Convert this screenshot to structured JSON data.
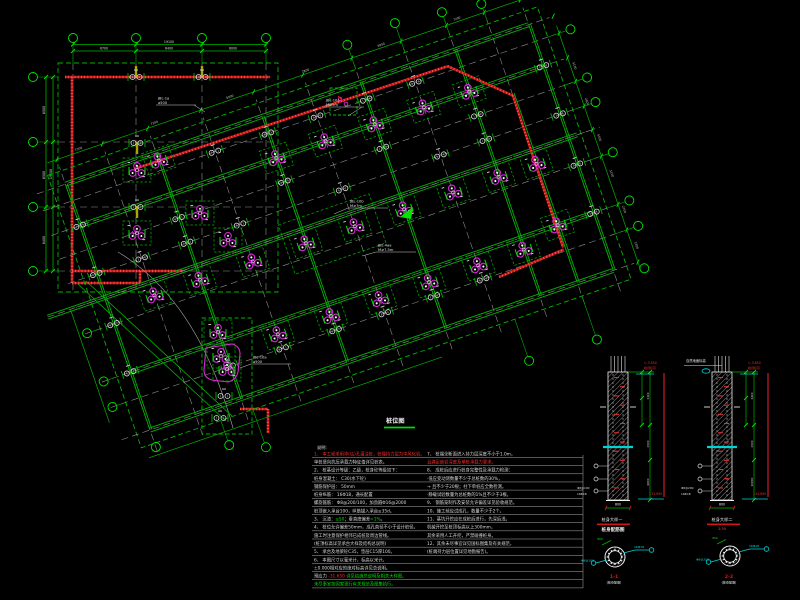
{
  "title": {
    "text": "桩位图"
  },
  "colors": {
    "green": "#00b400",
    "bright_green": "#00e400",
    "red": "#e41414",
    "wall_red": "#c81616",
    "magenta": "#d829d8",
    "cyan": "#00dcdc",
    "white": "#e6e6e6",
    "gray": "#8f8f8f",
    "yellow": "#a8a800",
    "rule": "#c0c0c0"
  },
  "plan": {
    "rotation_deg": -19,
    "pivot": [
      150,
      430
    ],
    "grid_x": [
      0,
      48,
      96,
      152,
      208,
      260,
      312,
      364,
      412,
      452,
      490
    ],
    "grid_y": [
      0,
      -34,
      -61,
      -112,
      -140,
      -165,
      -191,
      -216,
      -242,
      -260
    ],
    "clusters_local": [
      [
        152,
        -49
      ],
      [
        208,
        -49
      ],
      [
        260,
        -49
      ],
      [
        312,
        -49
      ],
      [
        364,
        -49
      ],
      [
        412,
        -49
      ],
      [
        48,
        -126
      ],
      [
        96,
        -126
      ],
      [
        152,
        -126
      ],
      [
        208,
        -126
      ],
      [
        260,
        -126
      ],
      [
        312,
        -126
      ],
      [
        364,
        -126
      ],
      [
        412,
        -126
      ],
      [
        208,
        -216
      ],
      [
        260,
        -216
      ],
      [
        312,
        -216
      ],
      [
        364,
        -216
      ],
      [
        412,
        -216
      ],
      [
        452,
        -61
      ],
      [
        452,
        -126
      ],
      [
        96,
        -252
      ]
    ],
    "pairs_local": [
      [
        96,
        -34
      ],
      [
        152,
        -34
      ],
      [
        208,
        -34
      ],
      [
        260,
        -34
      ],
      [
        312,
        -34
      ],
      [
        364,
        -34
      ],
      [
        48,
        -165
      ],
      [
        96,
        -165
      ],
      [
        152,
        -165
      ],
      [
        260,
        -165
      ],
      [
        364,
        -165
      ],
      [
        412,
        -165
      ],
      [
        96,
        -191
      ],
      [
        208,
        -191
      ],
      [
        312,
        -191
      ],
      [
        412,
        -191
      ],
      [
        152,
        -242
      ],
      [
        208,
        -242
      ],
      [
        260,
        -242
      ],
      [
        312,
        -242
      ],
      [
        364,
        -242
      ],
      [
        0,
        -61
      ],
      [
        0,
        -112
      ],
      [
        0,
        -165
      ],
      [
        0,
        -216
      ],
      [
        490,
        -61
      ],
      [
        490,
        -112
      ],
      [
        490,
        -165
      ],
      [
        490,
        -216
      ]
    ],
    "clusters_global": [
      [
        137,
        170
      ],
      [
        137,
        233
      ],
      [
        200,
        213
      ],
      [
        228,
        240
      ],
      [
        218,
        332
      ],
      [
        221,
        356
      ],
      [
        227,
        369
      ]
    ],
    "pairs_global": [
      [
        136,
        77
      ],
      [
        202,
        77
      ],
      [
        137,
        143
      ],
      [
        137,
        207
      ],
      [
        224,
        396
      ],
      [
        220,
        418
      ]
    ],
    "yellow_ticks": [
      [
        136,
        72
      ],
      [
        202,
        72
      ],
      [
        137,
        148
      ],
      [
        137,
        212
      ]
    ],
    "red_walls_global": [
      [
        65,
        77,
        270,
        77
      ],
      [
        72,
        77,
        72,
        283
      ],
      [
        72,
        271,
        183,
        271
      ],
      [
        140,
        271,
        140,
        283
      ],
      [
        72,
        283,
        140,
        283
      ],
      [
        240,
        409,
        268,
        409
      ],
      [
        268,
        409,
        268,
        433
      ]
    ],
    "red_walls_local": [
      [
        70,
        -252,
        400,
        -247
      ],
      [
        400,
        -247,
        452,
        -198
      ],
      [
        452,
        -198,
        450,
        -38
      ],
      [
        380,
        -31,
        450,
        -36
      ]
    ],
    "leaders": [
      {
        "x": 158,
        "y": 96,
        "lines": [
          "JBL-1a",
          "⌀500"
        ],
        "tail": [
          194,
          105,
          205,
          112
        ]
      },
      {
        "x": 326,
        "y": 98,
        "lines": [
          "JBL-10a",
          "M≥7m"
        ],
        "tail": [
          362,
          107,
          348,
          116
        ]
      },
      {
        "x": 350,
        "y": 199,
        "lines": [
          "JBL-10b",
          "M≥7m"
        ],
        "tail": [
          348,
          208,
          334,
          214
        ]
      },
      {
        "x": 378,
        "y": 243,
        "lines": [
          "JBL-4⌀a",
          "M≥7.5m"
        ],
        "tail": [
          376,
          252,
          362,
          256
        ]
      },
      {
        "x": 253,
        "y": 355,
        "lines": [
          "JBL-10a",
          "⌀500"
        ],
        "tail": [
          251,
          364,
          240,
          368
        ]
      }
    ],
    "dims": {
      "top_overall": "19100",
      "top_segs": [
        "6700",
        "6400",
        "6000"
      ],
      "left_overall": "19400",
      "left_segs": [
        "6500",
        "6500",
        "6400"
      ],
      "rot_top_segs": [
        "7200",
        "7200",
        "6900",
        "7800",
        "6900",
        "7200"
      ],
      "rot_right_segs": [
        "3300",
        "2700",
        "5100",
        "5300",
        "2600",
        "5100"
      ]
    }
  },
  "details": {
    "elev1": {
      "caption1": "桩身大样一",
      "caption2": "桩身配筋图",
      "top_red1": "▽-3.550",
      "top_red2": "桩顶标高",
      "bottom_red": "-31.650",
      "dim_width": "800",
      "seg_dims": [
        "1100",
        "2600",
        "9800"
      ],
      "side_texts": [
        "Φ8@100",
        "16Φ18"
      ]
    },
    "elev2": {
      "caption1": "桩身大样二",
      "caption2": "1:50",
      "top_red1": "▽-3.850",
      "top_red2": "桩顶标高",
      "bottom_red": "-34.650",
      "dim_width": "800",
      "seg_dims": [
        "1400",
        "2600",
        "10800"
      ],
      "side_texts": [
        "Φ8@200",
        "16Φ18"
      ],
      "top_leader": "自然地面标高"
    },
    "sec1": {
      "label": "1-1",
      "sub": "(桩身配筋)",
      "right_text": "16Φ18",
      "left_text": "Φ8@100",
      "dim": "800"
    },
    "sec2": {
      "label": "2-2",
      "sub": "(桩身配筋)",
      "right_text": "16Φ18",
      "left_text": "Φ8@200",
      "dim": "800"
    }
  },
  "notes": {
    "header": "说明:",
    "left": [
      [
        {
          "t": "1、 本工程采用冲(钻)孔灌注桩，桩端持力层为中风化岩。",
          "c": "r"
        }
      ],
      [
        {
          "t": "    单桩竖向抗压承载力特征值详见桩表。",
          "c": "w"
        }
      ],
      [
        {
          "t": "2、 桩基设计等级：乙级，桩身砼等级如下：",
          "c": "w"
        }
      ],
      [
        {
          "t": "    桩身混凝土：  C30(水下砼)",
          "c": "w"
        }
      ],
      [
        {
          "t": "    钢筋保护层：  50mm",
          "c": "w"
        }
      ],
      [
        {
          "t": "    桩身纵筋：  16Φ18，通长配置",
          "c": "w"
        }
      ],
      [
        {
          "t": "    螺旋箍筋：  Φ8@200/100，加劲箍Φ16@2000",
          "c": "w"
        }
      ],
      [
        {
          "t": "    桩顶嵌入承台100，纵筋锚入承台≥35d。",
          "c": "w"
        }
      ],
      [
        {
          "t": "3、 沉渣：",
          "c": "w"
        },
        {
          "t": "≤50",
          "c": "g"
        },
        {
          "t": "；垂直度偏差",
          "c": "w"
        },
        {
          "t": "<1%",
          "c": "g"
        },
        {
          "t": "。",
          "c": "w"
        }
      ],
      [
        {
          "t": "4、 桩位允许偏差50mm，成孔直径不小于设计桩径。",
          "c": "w"
        }
      ],
      [
        {
          "t": "    施工时注意保护相邻已成桩及周边管线。",
          "c": "w"
        }
      ],
      [
        {
          "t": "    (桩顶标高详见承台大样及结构总说明)",
          "c": "w"
        }
      ],
      [
        {
          "t": "5、 承台及地梁砼C35，垫层C15厚100。",
          "c": "w"
        }
      ],
      [
        {
          "t": "6、 本图尺寸以毫米计，标高以米计。",
          "c": "w"
        }
      ],
      [
        {
          "t": "    ±0.000相对应的绝对标高详见总说明。",
          "c": "w"
        }
      ],
      [
        {
          "t": "    预应力 ",
          "c": "w"
        },
        {
          "t": "-31.650",
          "c": "r"
        },
        {
          "t": "  详见结施总说明及相关大样图。",
          "c": "g"
        }
      ],
      [
        {
          "t": "    未尽事宜按国家现行有关规范及图集执行。",
          "c": "g"
        }
      ]
    ],
    "right": [
      [
        {
          "t": "7、 桩端全断面进入持力层深度不小于1.0m，",
          "c": "w"
        }
      ],
      [
        {
          "t": "    且满足嵌岩深度及单桩承载力要求。",
          "c": "r"
        }
      ],
      [
        {
          "t": "8、 成桩后应进行桩身完整性及承载力检测：",
          "c": "w"
        }
      ],
      [
        {
          "t": "    ·低应变动测数量不少于总桩数的30%，",
          "c": "w"
        }
      ],
      [
        {
          "t": "    → 且不少于20根；柱下单桩应全数检测。",
          "c": "w"
        }
      ],
      [
        {
          "t": "    ·静载试验数量为总桩数的1%且不少于3根。",
          "c": "w"
        }
      ],
      [
        {
          "t": "9、 钢筋笼制作及安装允许偏差详见验收规范。",
          "c": "w"
        }
      ],
      [
        {
          "t": "10、施工前应试成孔，数量不少于2个。",
          "c": "w"
        }
      ],
      [
        {
          "t": "11、基坑开挖应在成桩后进行，先深后浅，",
          "c": "w"
        }
      ],
      [
        {
          "t": "    机械开挖至桩顶标高以上300mm，",
          "c": "w"
        }
      ],
      [
        {
          "t": "    其余采用人工开挖，严禁碰撞桩身。",
          "c": "w"
        }
      ],
      [
        {
          "t": "12、其余未尽事宜详见国标图集及有关规范，",
          "c": "w"
        }
      ],
      [
        {
          "t": "    (桩端持力层位置详见地勘报告)。",
          "c": "w"
        }
      ]
    ]
  }
}
